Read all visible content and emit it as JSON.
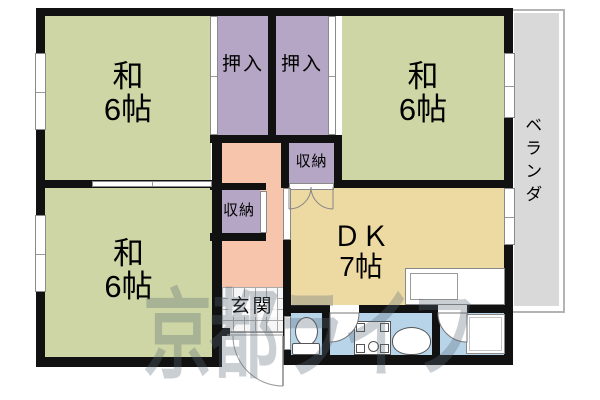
{
  "colors": {
    "room_green": "#cdd6a4",
    "closet_purple": "#b4a6c4",
    "hall_pink": "#f6c5ac",
    "dk_tan": "#eddaa3",
    "wet_blue": "#b7d4e9",
    "veranda_gray": "#d9d9d9",
    "wall_black": "#111111",
    "watermark_color": "rgba(90,105,120,0.32)"
  },
  "rooms": {
    "washitsu_top_left": {
      "line1": "和",
      "line2": "6帖"
    },
    "washitsu_top_right": {
      "line1": "和",
      "line2": "6帖"
    },
    "washitsu_bottom_left": {
      "line1": "和",
      "line2": "6帖"
    },
    "dk": {
      "line1": "ＤＫ",
      "line2": "7帖"
    },
    "oshiire_left": {
      "label": "押入"
    },
    "oshiire_right": {
      "label": "押入"
    },
    "storage_upper": {
      "label": "収納"
    },
    "storage_lower": {
      "label": "収納"
    },
    "genkan": {
      "label": "玄関"
    },
    "veranda": {
      "label": "ベランダ"
    }
  },
  "watermark": {
    "text": "京都ライフ"
  }
}
